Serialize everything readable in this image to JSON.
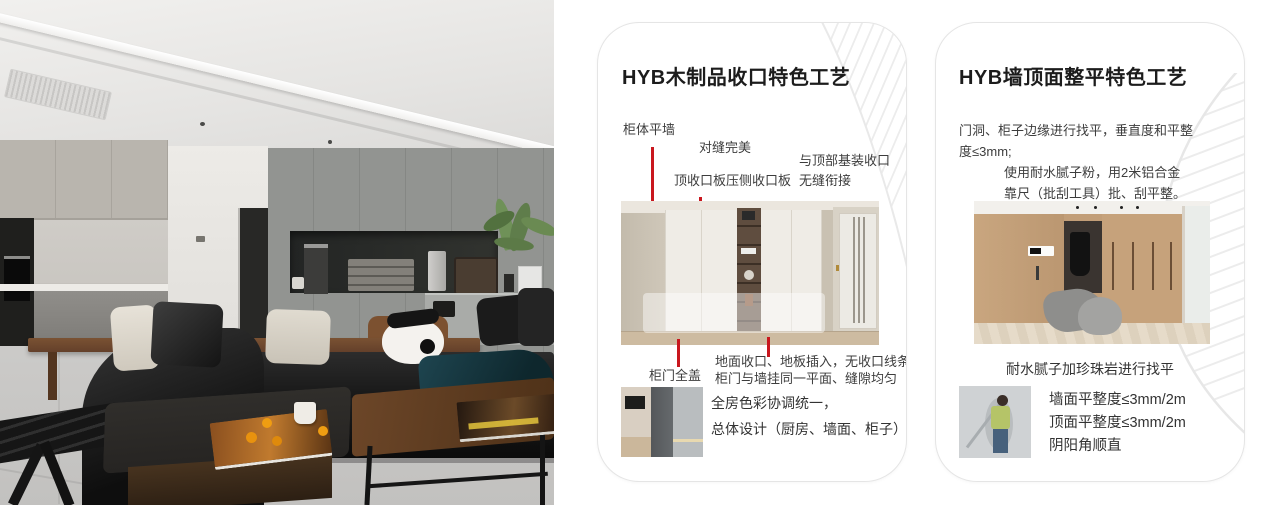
{
  "colors": {
    "accent_red": "#c9171e",
    "card_border": "#e5e5e5",
    "pattern_gray": "#ececec"
  },
  "card1": {
    "title": "HYB木制品收口特色工艺",
    "callout_cabinet_wall": "柜体平墙",
    "callout_seam_perfect": "对缝完美",
    "callout_top_board": "顶收口板压侧收口板",
    "callout_top_join": "与顶部基装收口无缝衔接",
    "callout_door_full_cover": "柜门全盖",
    "callout_floor_line1": "地面收口、地板插入，无收口线条",
    "callout_floor_line2": "柜门与墙挂同一平面、缝隙均匀",
    "summary_line1": "全房色彩协调统一，",
    "summary_line2": "总体设计（厨房、墙面、柜子）"
  },
  "card2": {
    "title": "HYB墙顶面整平特色工艺",
    "para_leveling": "门洞、柜子边缘进行找平，垂直度和平整度≤3mm;",
    "para_putty": "使用耐水腻子粉，用2米铝合金靠尺（批刮工具）批、刮平整。",
    "caption": "耐水腻子加珍珠岩进行找平",
    "spec_wall": "墙面平整度≤3mm/2m",
    "spec_ceiling": "顶面平整度≤3mm/2m",
    "spec_corners": "阴阳角顺直"
  }
}
